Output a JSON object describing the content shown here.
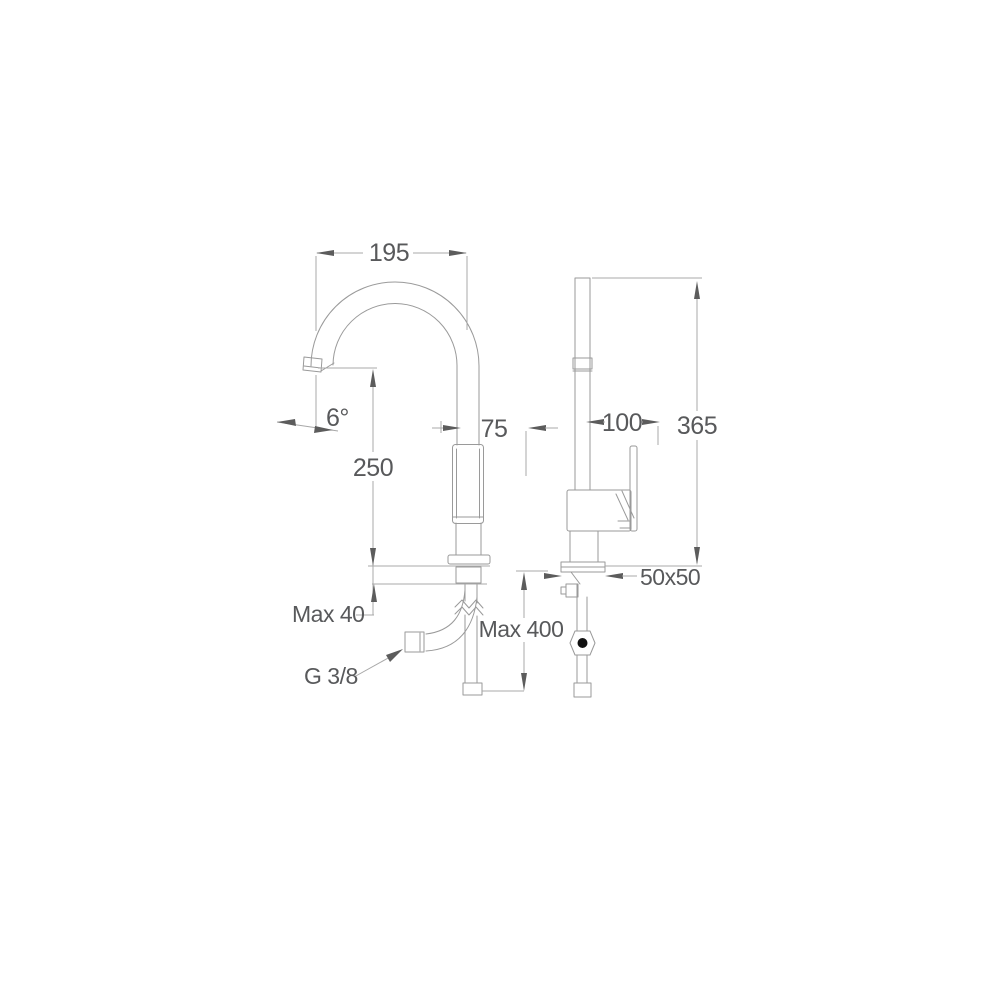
{
  "dimensions": {
    "spout_reach": {
      "label": "195"
    },
    "spout_angle": {
      "label": "6°"
    },
    "spout_height": {
      "label": "250"
    },
    "body_width": {
      "label": "75"
    },
    "handle_projection": {
      "label": "100"
    },
    "total_height": {
      "label": "365"
    },
    "max_deck_thickness": {
      "label": "Max 40"
    },
    "max_hose_length": {
      "label": "Max 400"
    },
    "base_plate_size": {
      "label": "50x50"
    },
    "supply_connection": {
      "label": "G 3/8"
    }
  },
  "colors": {
    "background": "#ffffff",
    "object_line": "#9a9a9a",
    "dimension_line": "#a8a8a8",
    "arrow": "#5c5c5c",
    "text": "#58595b",
    "dot": "#111111"
  }
}
